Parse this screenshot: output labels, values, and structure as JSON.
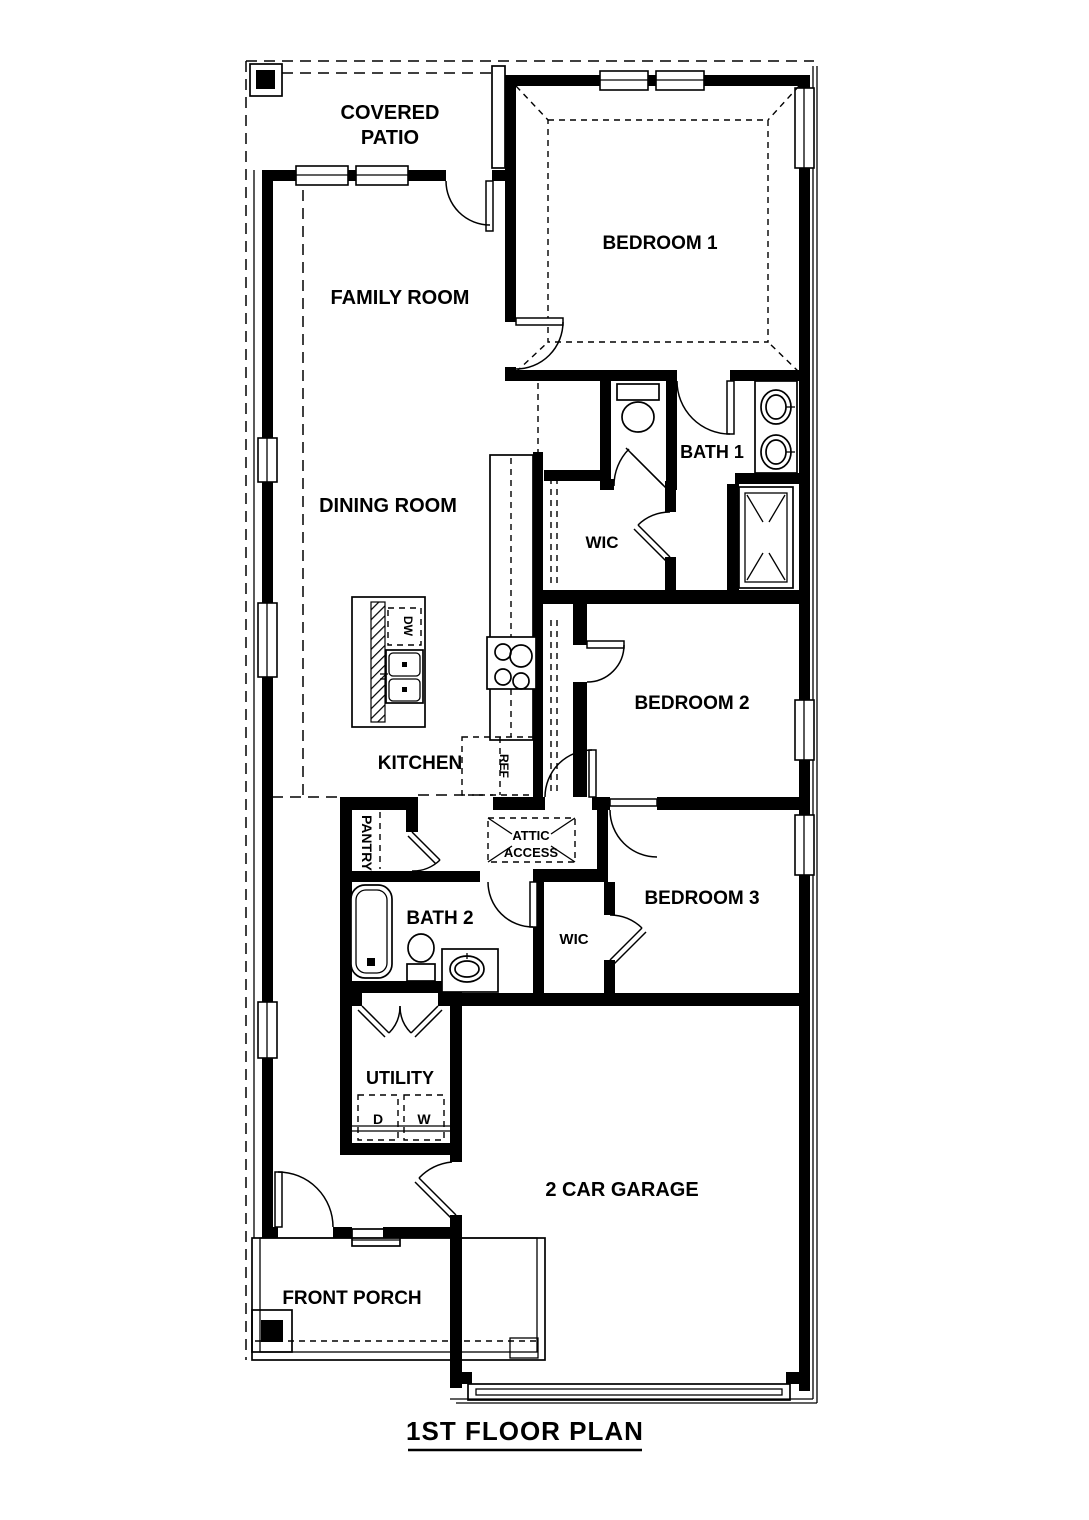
{
  "title": "1ST FLOOR PLAN",
  "rooms": {
    "covered_patio": {
      "line1": "COVERED",
      "line2": "PATIO"
    },
    "family_room": "FAMILY ROOM",
    "bedroom_1": "BEDROOM 1",
    "bath_1": "BATH 1",
    "wic_1": "WIC",
    "dining_room": "DINING ROOM",
    "kitchen": "KITCHEN",
    "bedroom_2": "BEDROOM 2",
    "pantry": "PANTRY",
    "attic_access": {
      "line1": "ATTIC",
      "line2": "ACCESS"
    },
    "bath_2": "BATH 2",
    "wic_2": "WIC",
    "bedroom_3": "BEDROOM 3",
    "utility": "UTILITY",
    "garage": "2 CAR GARAGE",
    "front_porch": "FRONT PORCH"
  },
  "appliances": {
    "dishwasher": "DW",
    "refrigerator": "REF",
    "dryer": "D",
    "washer": "W"
  },
  "colors": {
    "line": "#000000",
    "background": "#ffffff"
  }
}
